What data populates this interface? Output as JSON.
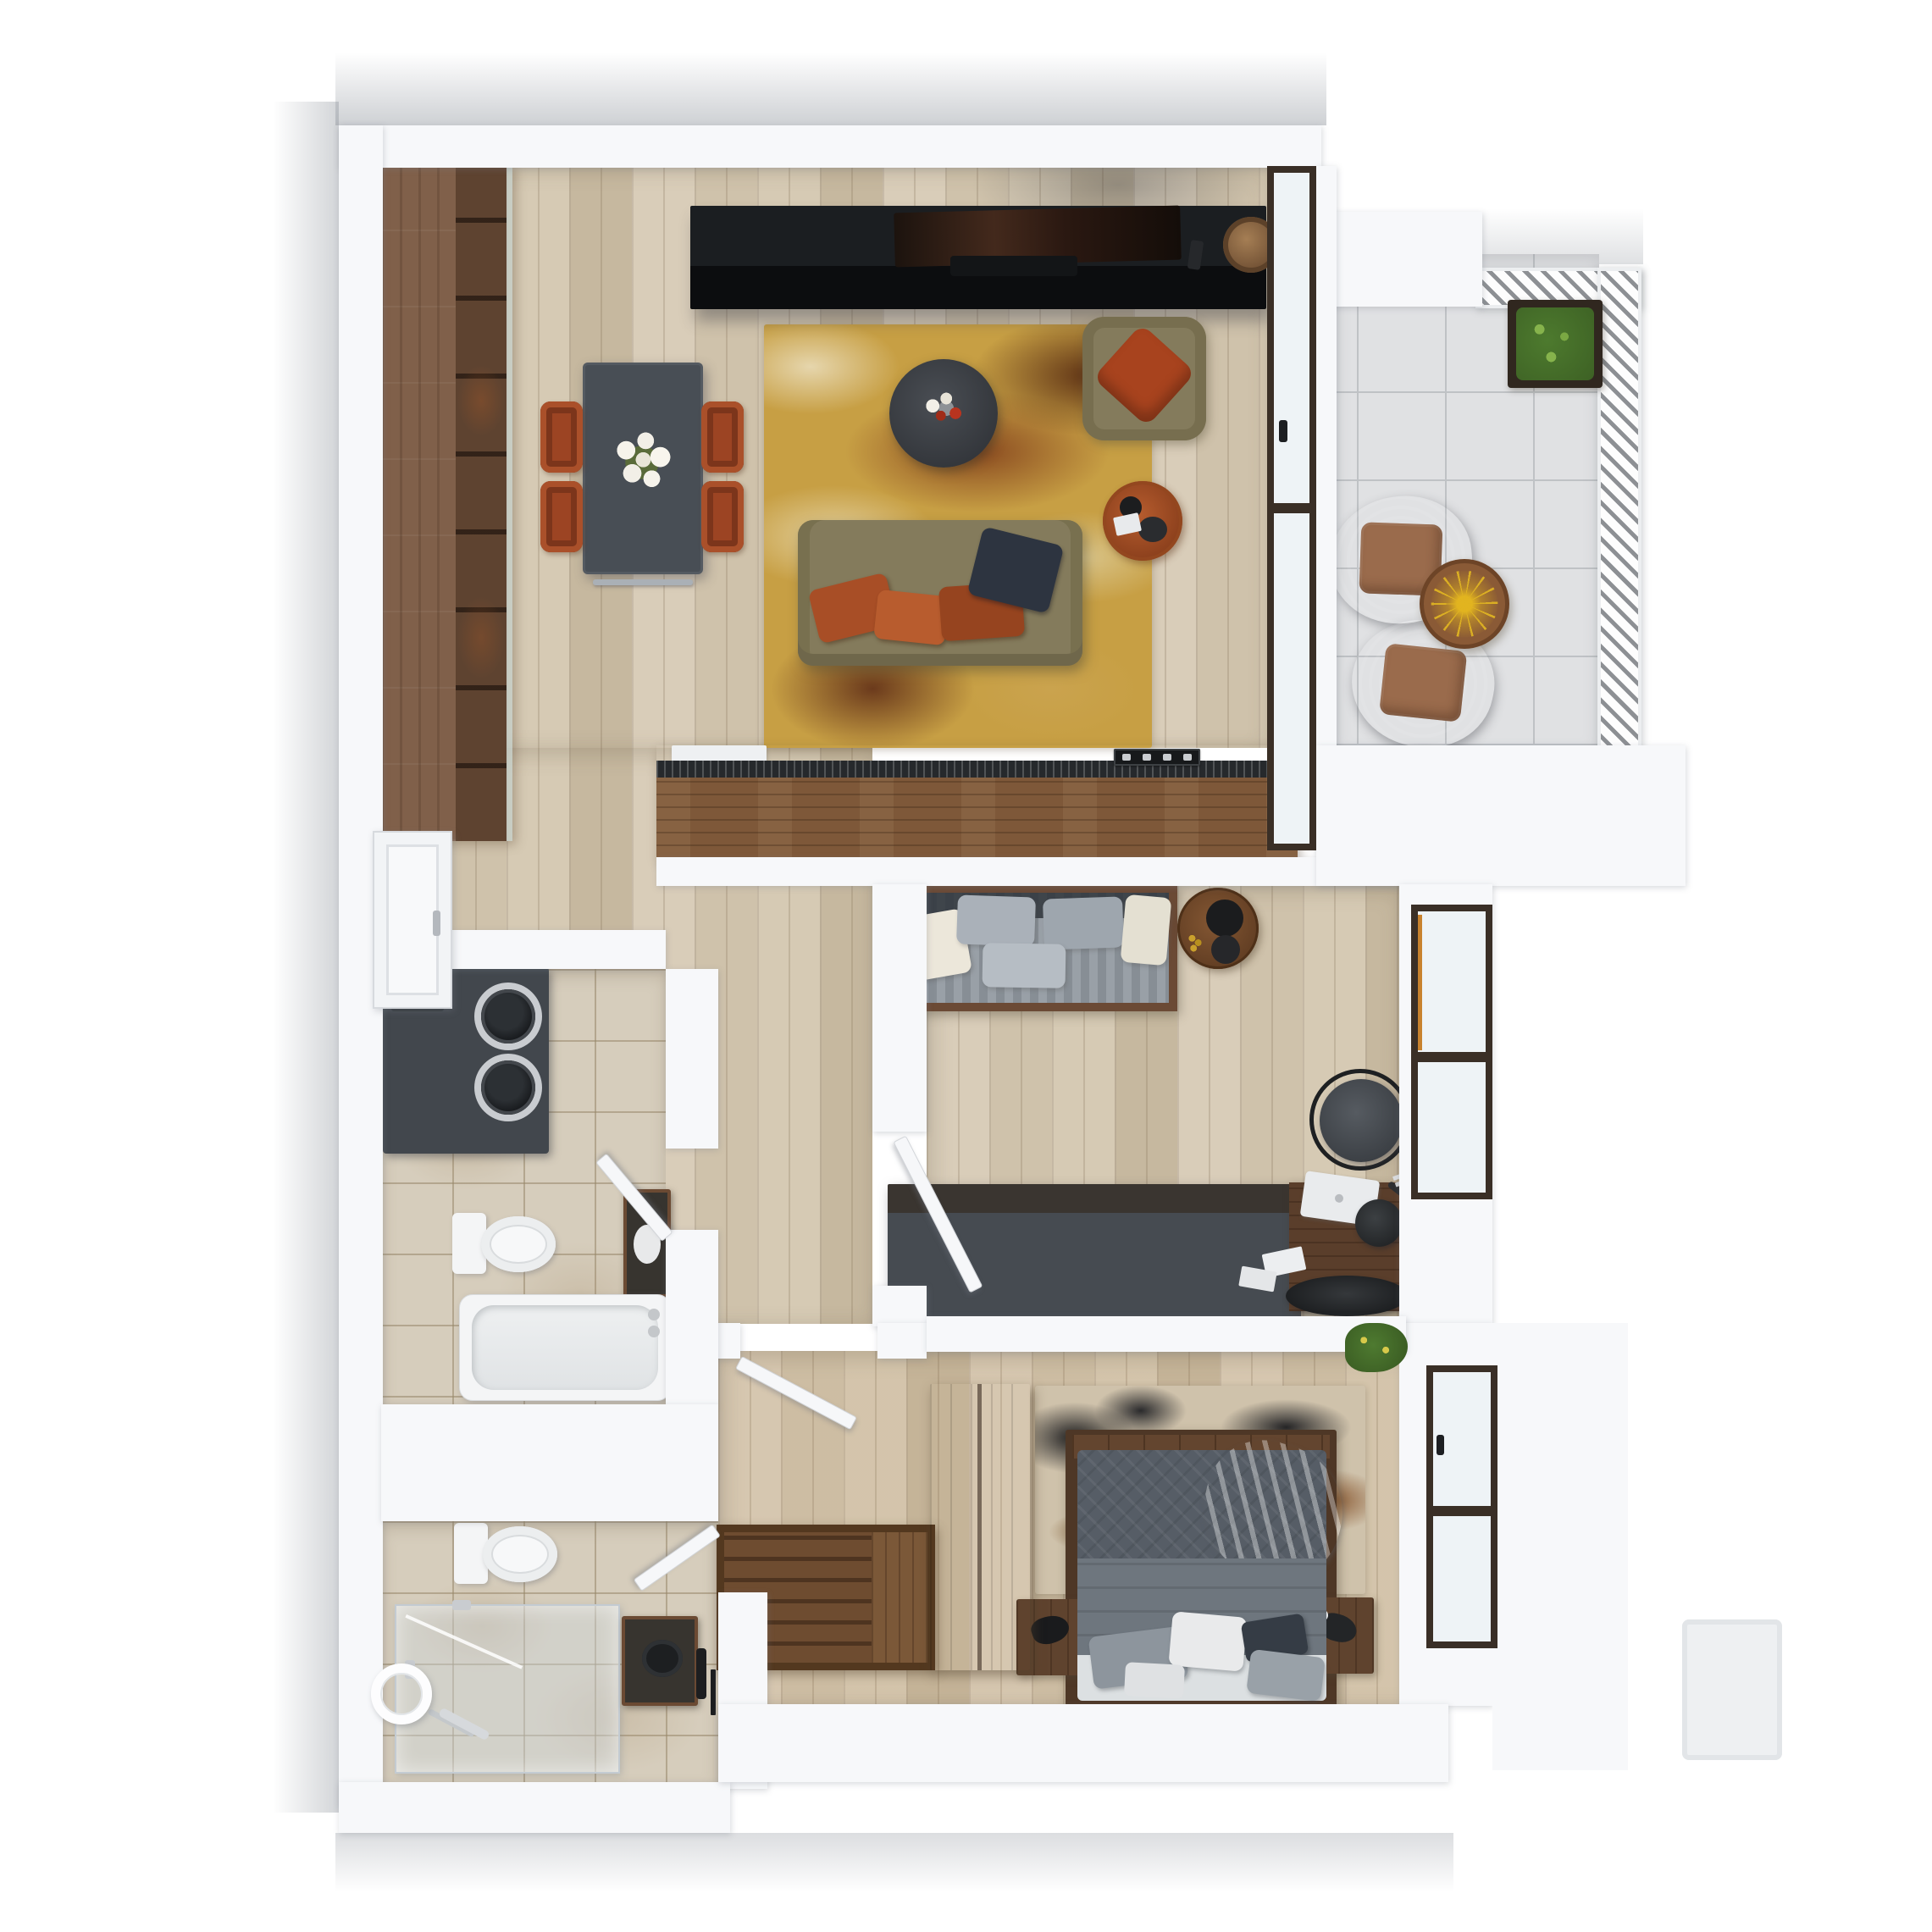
{
  "meta": {
    "title": "3D apartment floor plan - top-down render",
    "type": "architectural-floor-plan",
    "text_content": "none - image contains no text, labels or numbers"
  },
  "palette": {
    "wall": "#f7f8fa",
    "wood_floor": "#d3c6b0",
    "bath_tile": "#d6cdbc",
    "balcony_tile": "#e0e1e3",
    "cabinet_wood": "#80604a",
    "counter_wood": "#7e5839",
    "countertop": "#26292c",
    "tv_console": "#1b1e21",
    "dining_table": "#484e55",
    "chair_rust": "#9c4423",
    "rug_gold": "#c79f44",
    "sofa_olive": "#847b5c",
    "pillow_orange": "#a8431e",
    "pillow_navy": "#2d3440",
    "wicker_chair": "#221e1b",
    "wicker_cushion": "#9a6b4c",
    "balcony_table_wood": "#8a5a36",
    "balcony_table_star": "#e2b41f",
    "plant_green": "#4d7a2e",
    "daybed_wood": "#6b4a35",
    "mattress_gray": "#99a0a7",
    "desk_gray": "#464b51",
    "stool_gray": "#3b3f44",
    "bed_duvet_dark": "#565d66",
    "bed_duvet_mid": "#6e767e",
    "bed_throw": "#b6bcc2",
    "bed_platform": "#4e3726",
    "nightstand_wood": "#5f432e",
    "bedroom_rug_base": "#cfc2ab",
    "wardrobe_wood": "#5c3e28",
    "bench_wood": "#5d3f27",
    "fixture_white": "#f4f5f6",
    "appliance_dark": "#42474d",
    "window_frame": "#3a2f26",
    "glass": "#eef3f6",
    "door_white": "#f8f9fa"
  },
  "rooms": [
    {
      "id": "living-dining",
      "label": "Living / dining room with open kitchen",
      "floor": "light oak plank flooring",
      "furniture": [
        "kitchen cabinet run",
        "kitchen island with sink and cooktop",
        "TV console with TV, soundbar and basket",
        "dining table with flower centerpiece",
        "four rust dining chairs",
        "abstract gold-brown area rug",
        "round coffee table with flowers",
        "olive armchair with orange cushion",
        "olive sofa with orange and navy pillows",
        "round rust side table"
      ]
    },
    {
      "id": "balcony",
      "label": "Balcony",
      "floor": "gray ceramic tile",
      "furniture": [
        "metal slat railing",
        "planter box with greenery",
        "two wicker lounge chairs with cushions",
        "round bistro table"
      ]
    },
    {
      "id": "hallway",
      "label": "Hallway",
      "floor": "light oak plank flooring",
      "furniture": [
        "entry door"
      ]
    },
    {
      "id": "bathroom-1",
      "label": "Bathroom with bathtub and laundry",
      "floor": "beige stone tile",
      "furniture": [
        "stacked washer and dryer",
        "toilet",
        "dark sink cabinet",
        "bathtub"
      ]
    },
    {
      "id": "office",
      "label": "Office / guest room",
      "floor": "light oak plank flooring",
      "furniture": [
        "wood-framed daybed with gray mattress and pillows",
        "round wooden side table with kettle",
        "long dark desk with laptop, lamp and tray",
        "gray stool",
        "double casement window"
      ]
    },
    {
      "id": "bedroom",
      "label": "Bedroom",
      "floor": "light oak plank flooring",
      "furniture": [
        "platform double bed with gray bedding and throw",
        "two wooden nightstands",
        "abstract beige-black area rug",
        "hanging plant",
        "casement window"
      ]
    },
    {
      "id": "entry-hall",
      "label": "Entry hall with wardrobe",
      "floor": "light oak plank flooring",
      "furniture": [
        "slatted storage bench",
        "tall wooden wardrobe"
      ]
    },
    {
      "id": "bathroom-2",
      "label": "Shower bathroom",
      "floor": "beige stone tile",
      "furniture": [
        "toilet",
        "glass walk-in shower",
        "dark vessel sink cabinet",
        "towel ring",
        "handheld shower wand"
      ]
    }
  ]
}
